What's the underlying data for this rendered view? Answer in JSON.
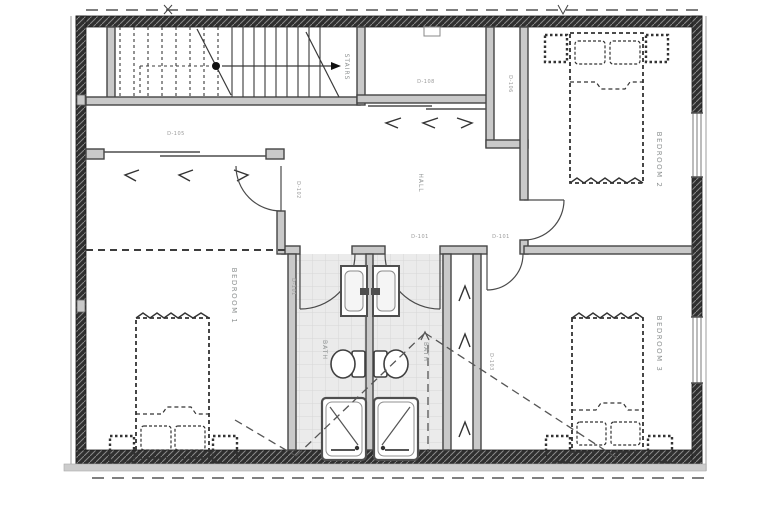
{
  "plan": {
    "rooms": {
      "stairs": "STAIRS",
      "hall": "HALL",
      "bedroom1": "BEDROOM 1",
      "bedroom2": "BEDROOM 2",
      "bedroom3": "BEDROOM 3",
      "bath1": "BATH",
      "bath2": "BATH"
    },
    "tags": {
      "closet_left": "D-105",
      "closet_top": "D-108",
      "linen": "D-106",
      "hall_a": "D-101",
      "hall_b": "D-101",
      "bedroom1_door": "D-102",
      "bath1_door": "D-101",
      "bedroom3_closet": "D-103"
    },
    "colors": {
      "exterior_wall": "#2f2f2f",
      "interior_wall_line": "#454545",
      "interior_wall_fill": "#c9c9c9",
      "fixture_line": "#555555",
      "furniture_dash": "#333333",
      "tile_floor": "#ebebeb",
      "label_gray": "#8d9191",
      "paper": "#ffffff"
    },
    "fixtures": [
      "stair-run",
      "double-bed",
      "nightstand",
      "pillow",
      "vanity-sink",
      "toilet",
      "shower-stall",
      "door-swing",
      "sliding-closet-door",
      "window"
    ]
  }
}
